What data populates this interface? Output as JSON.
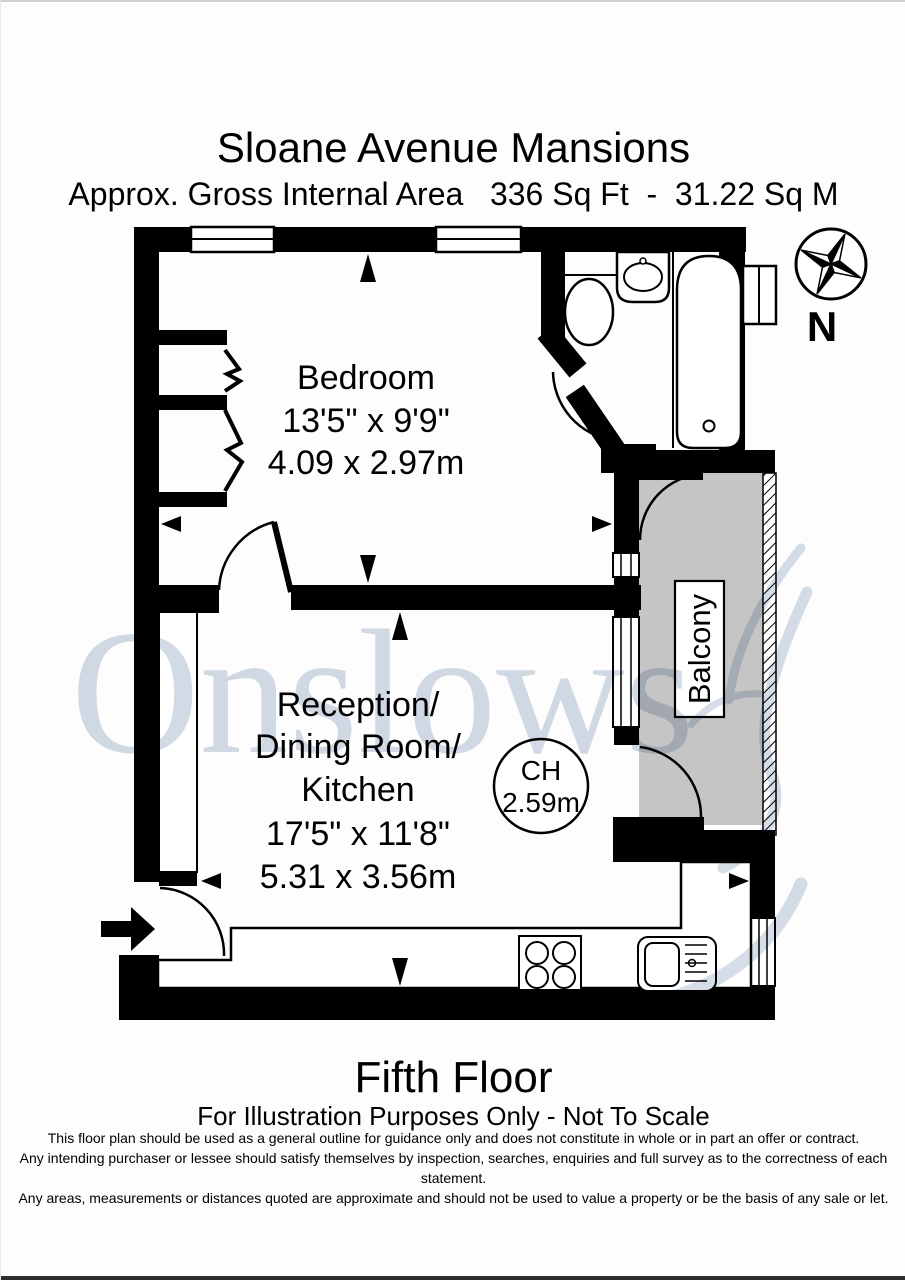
{
  "header": {
    "title": "Sloane Avenue Mansions",
    "subtitle": "Approx. Gross Internal Area   336 Sq Ft  -  31.22 Sq M"
  },
  "plan": {
    "bedroom": {
      "name": "Bedroom",
      "size_imperial": "13'5\" x 9'9\"",
      "size_metric": "4.09 x 2.97m"
    },
    "reception": {
      "line1": "Reception/",
      "line2": "Dining Room/",
      "line3": "Kitchen",
      "size_imperial": "17'5\" x 11'8\"",
      "size_metric": "5.31 x 3.56m"
    },
    "balcony": {
      "name": "Balcony"
    },
    "ceiling": {
      "label": "CH",
      "value": "2.59m"
    }
  },
  "compass": {
    "north_label": "N"
  },
  "watermark": {
    "text": "Onslows"
  },
  "footer": {
    "floor": "Fifth Floor",
    "note": "For Illustration Purposes Only - Not To Scale",
    "disclaimer_line1": "This floor plan should be used as a general outline for guidance only and does not constitute in whole or in part an offer or contract.",
    "disclaimer_line2": "Any intending purchaser or lessee should satisfy themselves by inspection, searches, enquiries and full survey as to the correctness of each statement.",
    "disclaimer_line3": "Any areas, measurements or distances quoted are approximate and should not be used to value a property or be the basis of any sale or let."
  },
  "colors": {
    "wall": "#000000",
    "balcony_fill": "#c5c5c5",
    "watermark_text": "#cbd4e1",
    "watermark_swoosh": "#c3cfdf"
  }
}
